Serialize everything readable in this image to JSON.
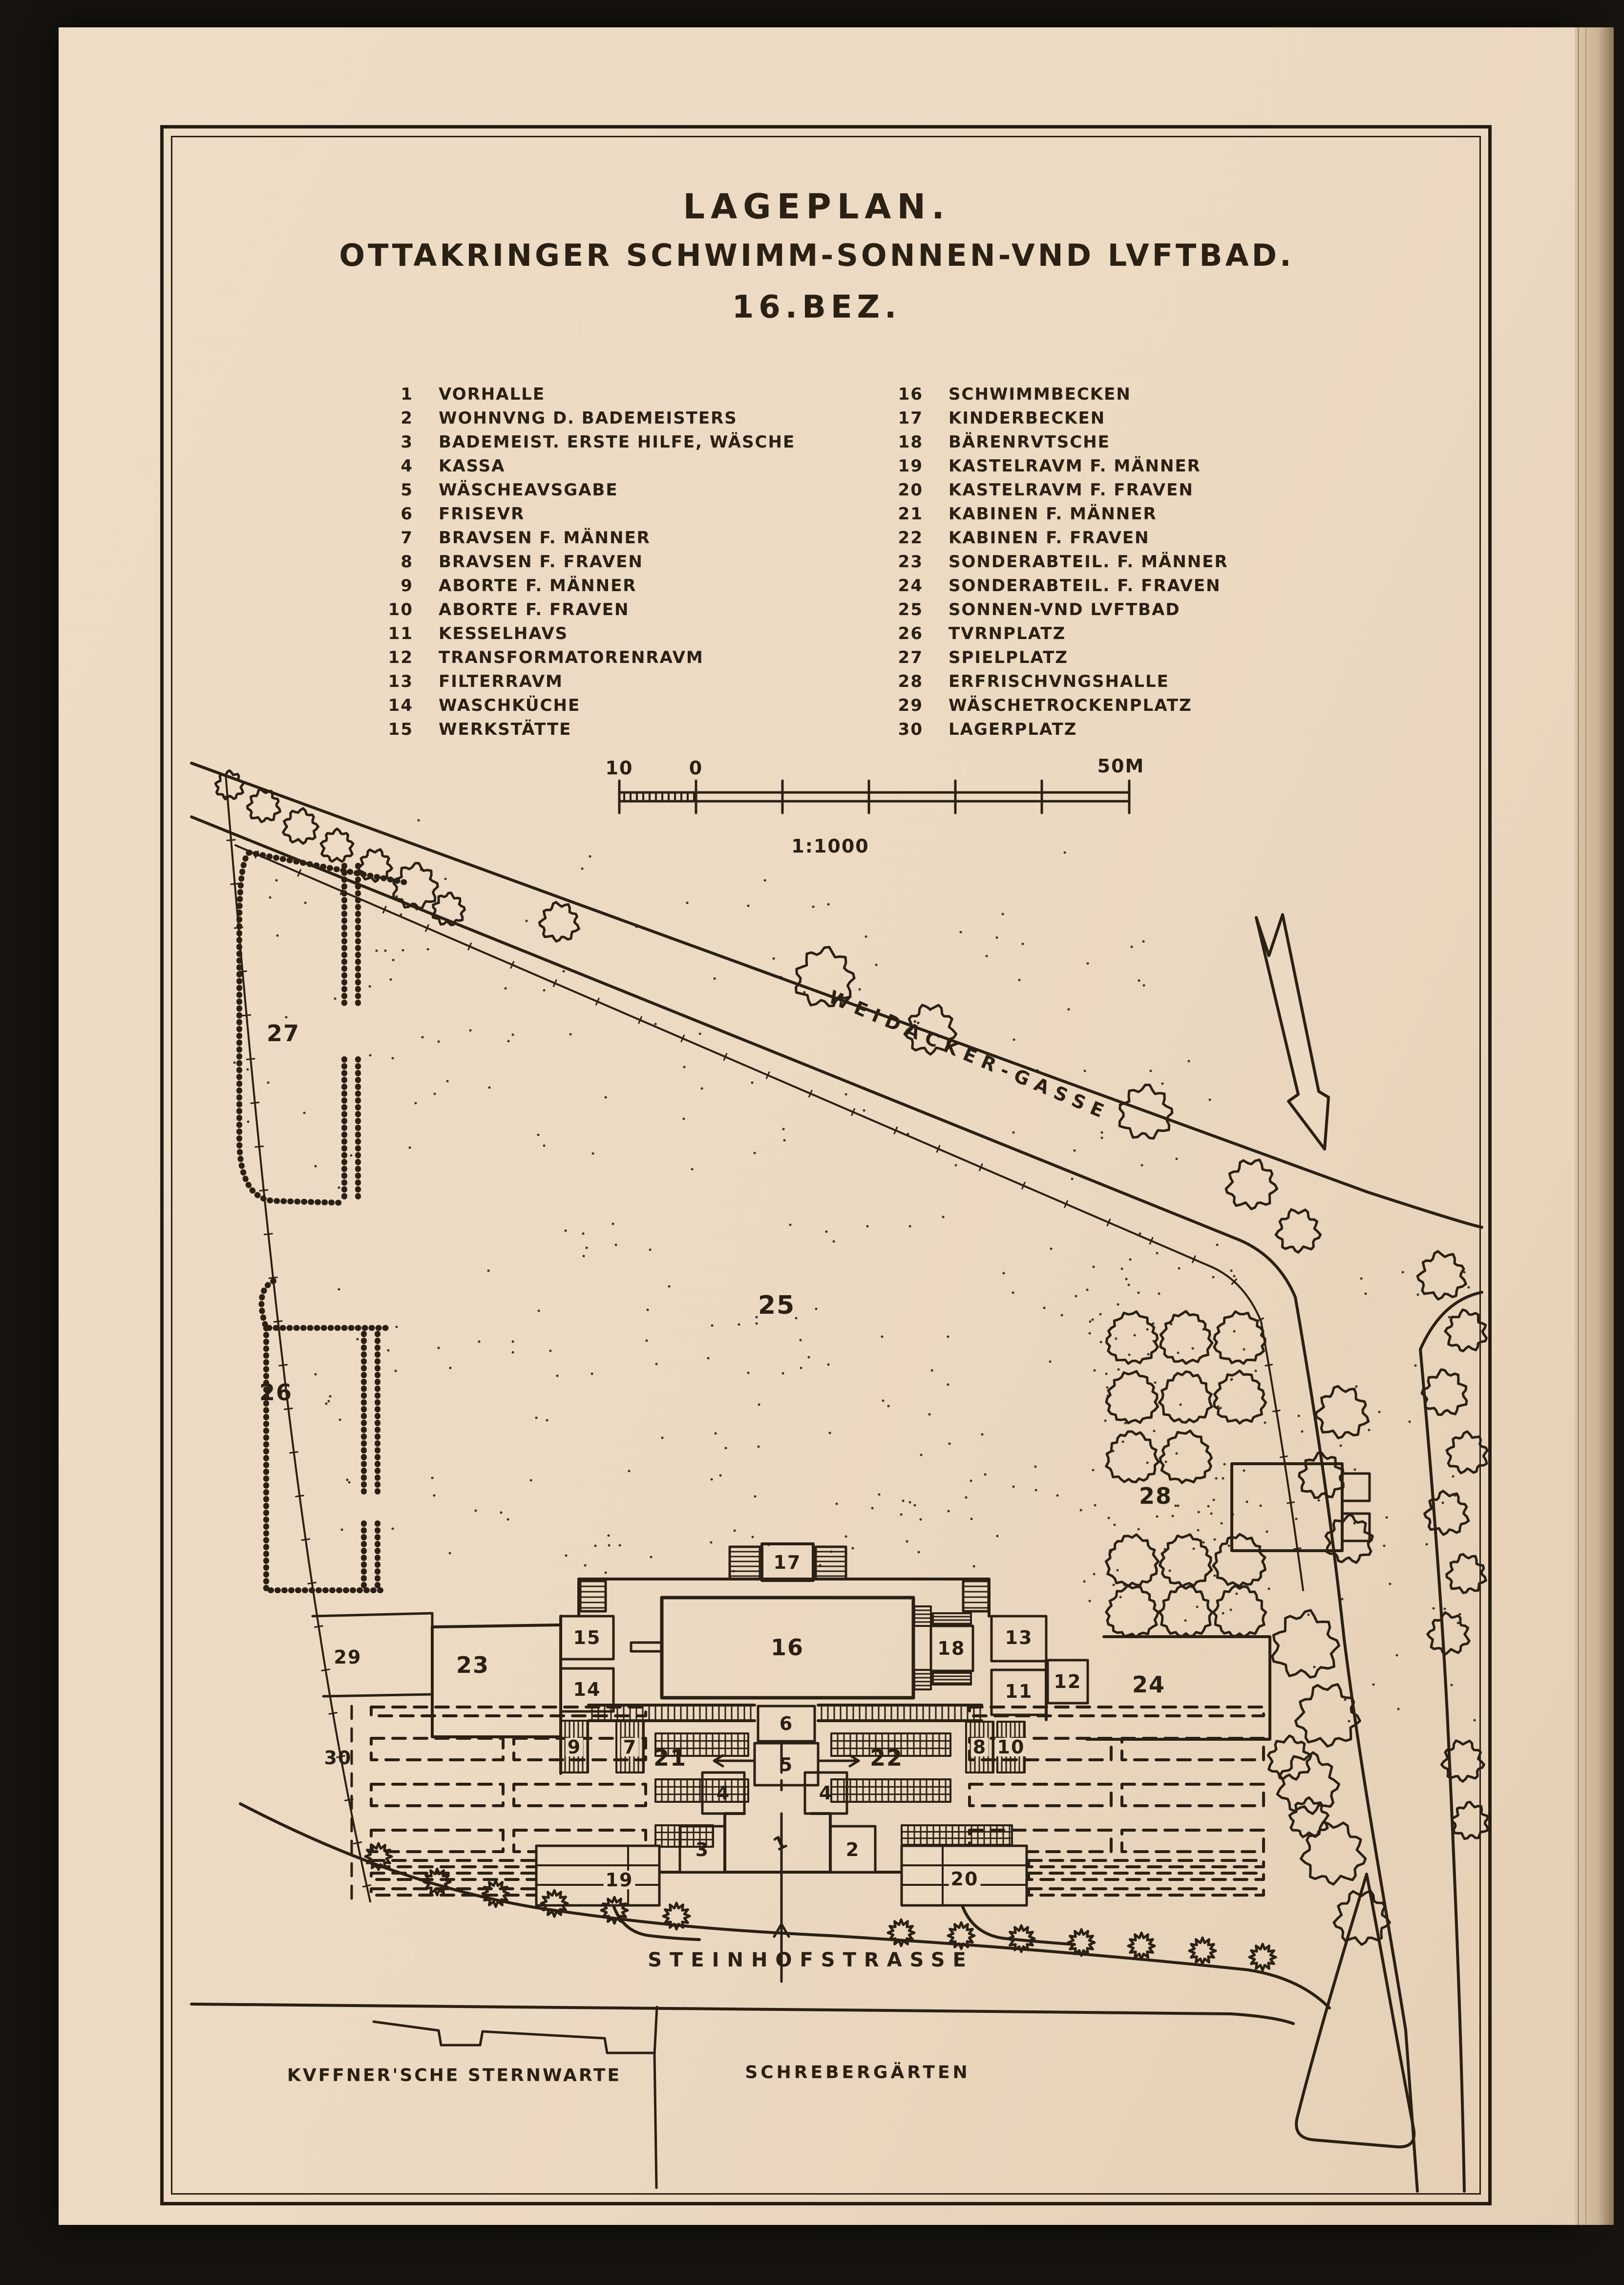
{
  "title": {
    "line1": "LAGEPLAN.",
    "line2": "OTTAKRINGER SCHWIMM-SONNEN-VND LVFTBAD.",
    "line3": "16.BEZ."
  },
  "legend": {
    "col1": [
      {
        "num": "1",
        "label": "VORHALLE"
      },
      {
        "num": "2",
        "label": "WOHNVNG D. BADEMEISTERS"
      },
      {
        "num": "3",
        "label": "BADEMEIST. ERSTE HILFE, WÄSCHE"
      },
      {
        "num": "4",
        "label": "KASSA"
      },
      {
        "num": "5",
        "label": "WÄSCHEAVSGABE"
      },
      {
        "num": "6",
        "label": "FRISEVR"
      },
      {
        "num": "7",
        "label": "BRAVSEN F. MÄNNER"
      },
      {
        "num": "8",
        "label": "BRAVSEN F. FRAVEN"
      },
      {
        "num": "9",
        "label": "ABORTE F. MÄNNER"
      },
      {
        "num": "10",
        "label": "ABORTE F. FRAVEN"
      },
      {
        "num": "11",
        "label": "KESSELHAVS"
      },
      {
        "num": "12",
        "label": "TRANSFORMATORENRAVM"
      },
      {
        "num": "13",
        "label": "FILTERRAVM"
      },
      {
        "num": "14",
        "label": "WASCHKÜCHE"
      },
      {
        "num": "15",
        "label": "WERKSTÄTTE"
      }
    ],
    "col2": [
      {
        "num": "16",
        "label": "SCHWIMMBECKEN"
      },
      {
        "num": "17",
        "label": "KINDERBECKEN"
      },
      {
        "num": "18",
        "label": "BÄRENRVTSCHE"
      },
      {
        "num": "19",
        "label": "KASTELRAVM F. MÄNNER"
      },
      {
        "num": "20",
        "label": "KASTELRAVM F. FRAVEN"
      },
      {
        "num": "21",
        "label": "KABINEN F. MÄNNER"
      },
      {
        "num": "22",
        "label": "KABINEN F. FRAVEN"
      },
      {
        "num": "23",
        "label": "SONDERABTEIL. F. MÄNNER"
      },
      {
        "num": "24",
        "label": "SONDERABTEIL. F. FRAVEN"
      },
      {
        "num": "25",
        "label": "SONNEN-VND LVFTBAD"
      },
      {
        "num": "26",
        "label": "TVRNPLATZ"
      },
      {
        "num": "27",
        "label": "SPIELPLATZ"
      },
      {
        "num": "28",
        "label": "ERFRISCHVNGSHALLE"
      },
      {
        "num": "29",
        "label": "WÄSCHETROCKENPLATZ"
      },
      {
        "num": "30",
        "label": "LAGERPLATZ"
      }
    ]
  },
  "scale_bar": {
    "left": "10",
    "zero": "0",
    "right": "50M",
    "ratio": "1:1000"
  },
  "plan": {
    "labels": {
      "l1": "1",
      "l2": "2",
      "l3": "3",
      "l4": "4",
      "l5": "5",
      "l6": "6",
      "l7": "7",
      "l8": "8",
      "l9": "9",
      "l10": "10",
      "l11": "11",
      "l12": "12",
      "l13": "13",
      "l14": "14",
      "l15": "15",
      "l16": "16",
      "l17": "17",
      "l18": "18",
      "l19": "19",
      "l20": "20",
      "l21": "21",
      "l22": "22",
      "l23": "23",
      "l24": "24",
      "l25": "25",
      "l26": "26",
      "l27": "27",
      "l28": "28",
      "l29": "29",
      "l30": "30"
    },
    "streets": {
      "weidaecker": "WEIDÄCKER-GASSE",
      "steinhof": "STEINHOFSTRASSE",
      "kuffner": "KVFFNER'SCHE STERNWARTE",
      "schreber": "SCHREBERGÄRTEN"
    }
  },
  "colors": {
    "paper": "#ecd9c2",
    "ink": "#2a2014",
    "background": "#131110"
  }
}
